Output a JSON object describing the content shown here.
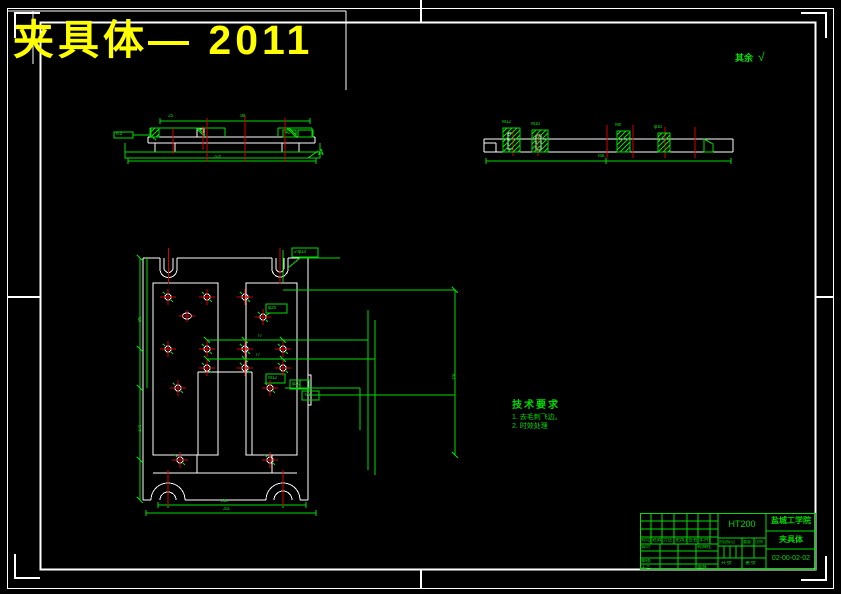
{
  "sheet": {
    "title": "夹具体— 2011",
    "surface_note": "其余",
    "surface_check": "√"
  },
  "colors": {
    "green": "#00dc00",
    "red": "#d40000",
    "white": "#ffffff",
    "yellow": "#ffff00"
  },
  "tech_req": {
    "title": "技术要求",
    "items": [
      "1. 去毛刺飞边。",
      "2. 时效处理"
    ]
  },
  "title_block": {
    "material": "HT200",
    "company": "盐城工学院",
    "part": "夹具体",
    "drawing_no": "02-00-02-02",
    "row_labels": [
      "标记",
      "处数",
      "分区",
      "更改文件号",
      "签名",
      "年月日"
    ],
    "design": "设计",
    "standard": "标准化",
    "check": "审核",
    "process": "工艺",
    "approve": "批准",
    "stage": "阶段标记",
    "weight": "重量",
    "scale": "比例",
    "sheets": "共 张",
    "page": "第 张"
  },
  "dims": {
    "front": {
      "leader": "6.3",
      "top1": "25",
      "top2": "98",
      "top3": "40",
      "bottom": "318",
      "view": "A"
    },
    "side": {
      "b1": "M12",
      "b2": "M10",
      "b3": "M8",
      "b4": "φ10",
      "bottom": "690"
    },
    "plan": {
      "h1": "77",
      "h2": "77",
      "bottom1": "230",
      "bottom2": "310",
      "left1": "95",
      "left2": "175",
      "right1": "150",
      "lbl1": "M12",
      "lbl2": "φ20",
      "lbl3": "60",
      "slot": "2-φ13",
      "box": "φ25"
    }
  }
}
